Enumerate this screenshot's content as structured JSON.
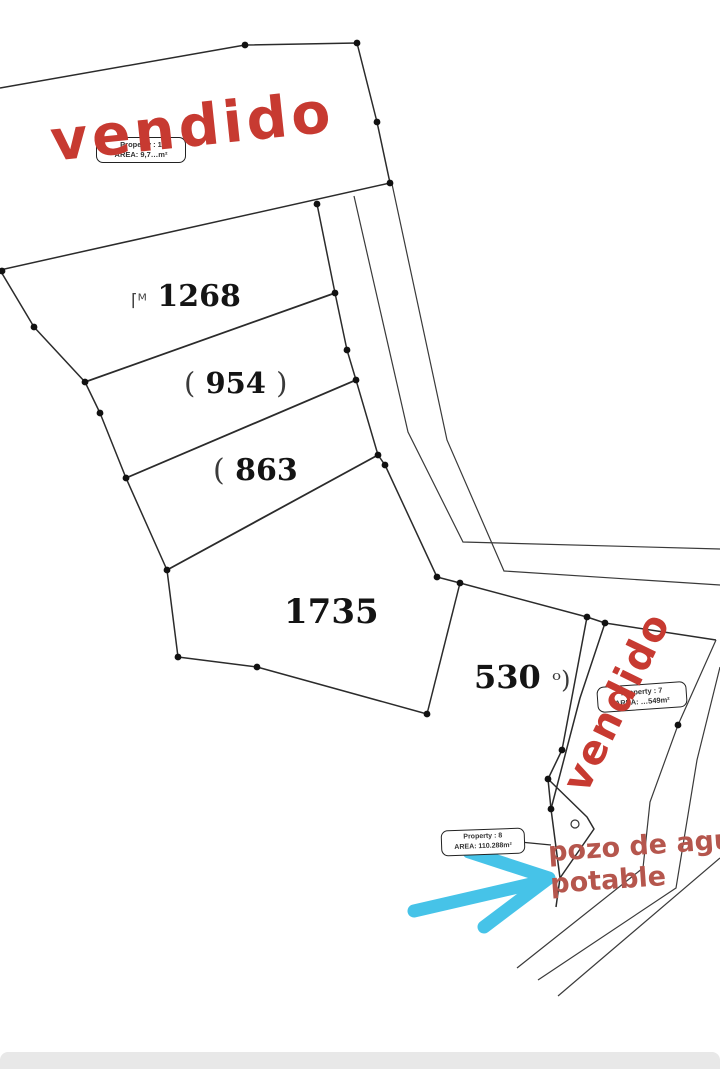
{
  "colors": {
    "line": "#2b2b2b",
    "stamp_red": "#c73a31",
    "note_red": "#b5564d",
    "arrow_blue": "#46c3e8",
    "bottom_bar": "#e8e8e8"
  },
  "stamps": {
    "property1": "vendido",
    "property7": "vendido"
  },
  "property_labels": {
    "p1": {
      "line1": "Property : 1",
      "line2": "AREA: 9,7…m²"
    },
    "p7": {
      "line1": "Property : 7",
      "line2": "AREA: …549m²"
    },
    "p8": {
      "line1": "Property : 8",
      "line2": "AREA: 110.288m²"
    }
  },
  "plot_numbers": {
    "p1268": {
      "prefix": "⌈ᴹ",
      "value": "1268"
    },
    "p954": {
      "prefix": "(",
      "value": "954",
      "suffix": ")"
    },
    "p863": {
      "prefix": "(",
      "value": "863"
    },
    "p1735": {
      "value": "1735"
    },
    "p530": {
      "value": "530",
      "suffix": "ᵒ)"
    }
  },
  "annotations": {
    "well_note_line1": "pozo de agua",
    "well_note_line2": "potable"
  }
}
